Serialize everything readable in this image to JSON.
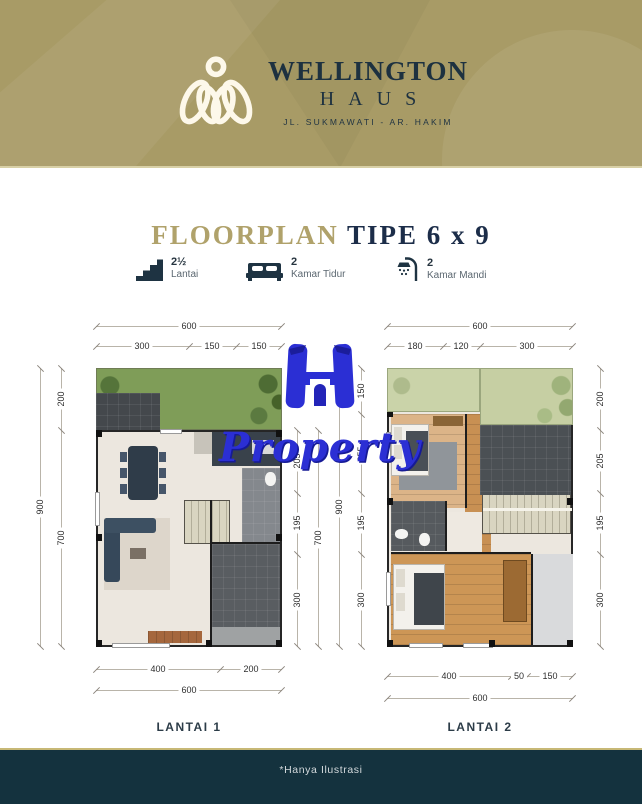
{
  "header": {
    "brand": "WELLINGTON",
    "brand_sub": "HAUS",
    "address": "JL. SUKMAWATI - AR. HAKIM",
    "bg_color": "#a89b66",
    "text_color": "#1d3140"
  },
  "title": {
    "accent_word": "FLOORPLAN",
    "rest": " TIPE 6 x 9",
    "accent_color": "#b0a26b",
    "navy_color": "#1c2d49"
  },
  "features": [
    {
      "icon": "stairs-icon",
      "value": "2½",
      "label": "Lantai"
    },
    {
      "icon": "bed-icon",
      "value": "2",
      "label": "Kamar Tidur"
    },
    {
      "icon": "shower-icon",
      "value": "2",
      "label": "Kamar Mandi"
    }
  ],
  "watermark": {
    "monogram": "H",
    "text": "Property",
    "color": "#2b2fd4"
  },
  "plans": [
    {
      "name": "LANTAI 1",
      "dims": {
        "top_total": "600",
        "top": [
          "300",
          "150",
          "150"
        ],
        "left_total": "900",
        "left": [
          "200",
          "700"
        ],
        "right": [
          "205",
          "195",
          "300"
        ],
        "right_total": "700",
        "bottom": [
          "400",
          "200"
        ],
        "bottom_total": "600"
      }
    },
    {
      "name": "LANTAI 2",
      "dims": {
        "top_total": "600",
        "top": [
          "180",
          "120",
          "300"
        ],
        "left_total": "900",
        "left": [
          "150",
          "255",
          "195",
          "300"
        ],
        "right": [
          "200",
          "205",
          "195",
          "300"
        ],
        "bottom": [
          "400",
          "50",
          "150"
        ],
        "bottom_total": "600"
      }
    }
  ],
  "footer": {
    "note": "*Hanya Ilustrasi",
    "bg": "#14323e"
  }
}
